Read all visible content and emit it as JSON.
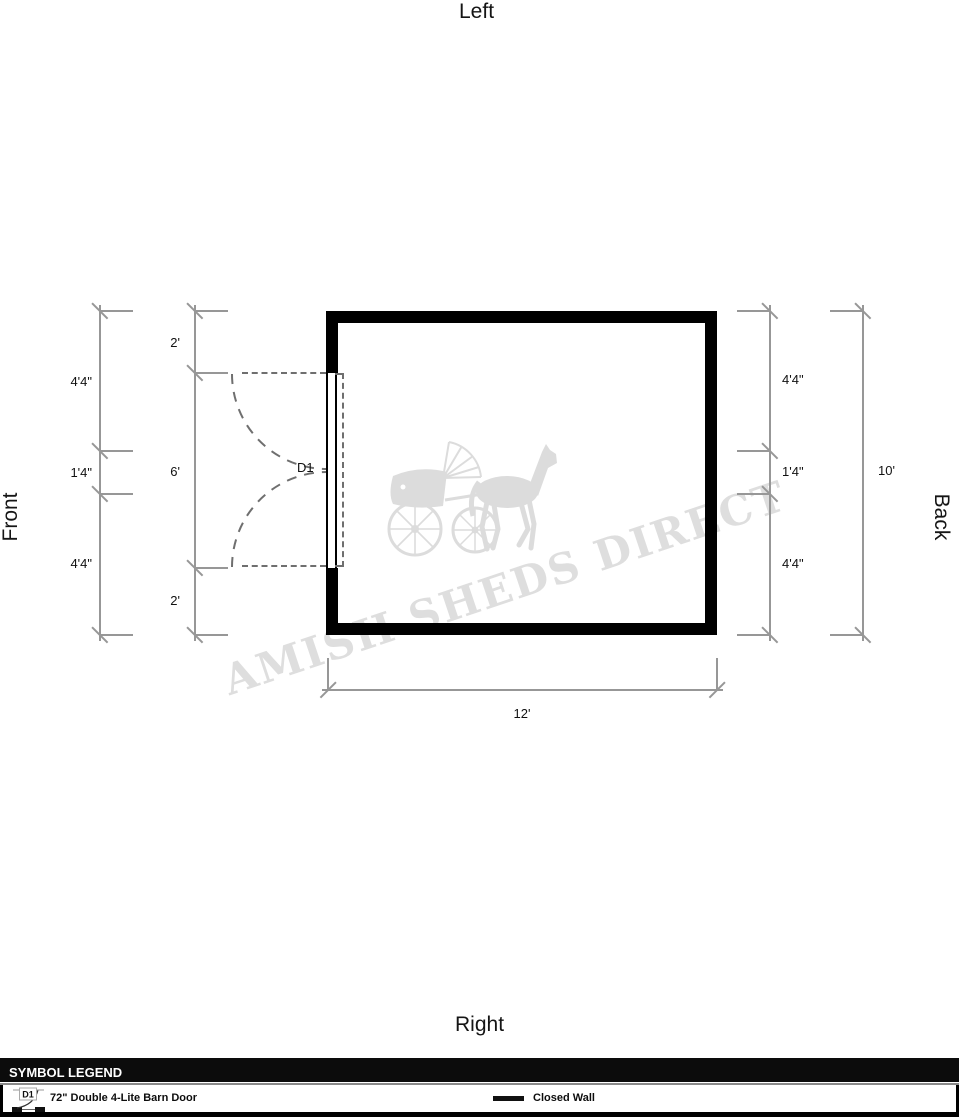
{
  "orientation": {
    "top": "Left",
    "bottom": "Right",
    "left": "Front",
    "right": "Back"
  },
  "watermark": {
    "text": "AMISH SHEDS DIRECT",
    "icon": "horse-and-buggy-icon"
  },
  "floor_plan": {
    "door_label": "D1",
    "dimensions": {
      "left_outer": [
        "4'4\"",
        "1'4\"",
        "4'4\""
      ],
      "left_inner": [
        "2'",
        "6'",
        "2'"
      ],
      "right_inner": [
        "4'4\"",
        "1'4\"",
        "4'4\""
      ],
      "right_outer": "10'",
      "bottom": "12'"
    }
  },
  "legend": {
    "title": "SYMBOL LEGEND",
    "items": [
      {
        "symbol": "door-swing-icon",
        "code": "D1",
        "label": "72\" Double 4-Lite Barn Door"
      },
      {
        "symbol": "closed-wall-line",
        "label": "Closed Wall"
      }
    ]
  },
  "colors": {
    "wall": "#000000",
    "dimension_line": "#979797",
    "door_dash": "#6f6f6f",
    "watermark": "#dedede",
    "legend_header_bg": "#0c0c0c"
  }
}
